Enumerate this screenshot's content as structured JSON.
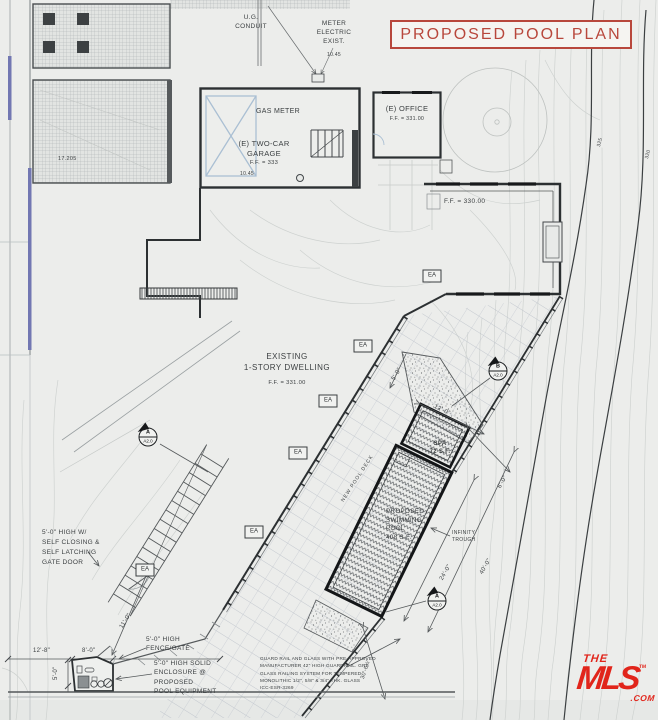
{
  "title": "PROPOSED POOL PLAN",
  "colors": {
    "title_red": "#b8473c",
    "mls_red": "#e1251b",
    "paper": "#ecedeb",
    "ink": "#3b3f41"
  },
  "site": {
    "ug_conduit": "U.G.\nCONDUIT",
    "meter_electric": "METER\nELECTRIC\nEXIST.",
    "gas_meter": "GAS METER",
    "garage_name": "(E) TWO-CAR\nGARAGE",
    "garage_ff": "F.F. = 333",
    "office_name": "(E) OFFICE",
    "office_ff": "F.F. = 331.00",
    "wing_ff": "F.F. = 330.00",
    "dwelling_name": "EXISTING\n1-STORY DWELLING",
    "dwelling_ff": "F.F. = 331.00",
    "spa": "SPA\n72 S.F.",
    "pool": "PROPOSED\nSWIMMING\nPOOL\n408 S.F.",
    "infinity": "INFINITY\nTROUGH",
    "deck_label": "NEW POOL DECK",
    "gate_door": "5'-0\" HIGH   W/\nSELF CLOSING &\nSELF LATCHING\nGATE DOOR",
    "fence_gate": "5'-0\" HIGH\nFENCE/GATE",
    "enclosure": "5'-0\" HIGH SOLID\nENCLOSURE @\nPROPOSED\nPOOL EQUIPMENT",
    "note": "GUARD RAIL AND GLASS WITH PRE-APPROVED\nMANUFACTURER 42\" HIGH GUARDRAIL.   GRS\nGLASS RAILING SYSTEM FOR TEMPERED\nMONOLITHIC 1/2\", 5/8\" & 3/4\" THK. GLASS\nICC-ESR-3269"
  },
  "markers": {
    "ea": "EA",
    "section_a": "A",
    "section_b": "B",
    "sheet": "A2.0"
  },
  "dims": {
    "d17205": "17.205",
    "d1045a": "10.45",
    "d1045b": "10.45",
    "d128": "12'-8\"",
    "d80": "8'-0\"",
    "d50": "5'-0\"",
    "d50b": "5'-0\"",
    "d110": "11'-0\"",
    "d3065": "30'-6½\"",
    "d240": "24'-0\"",
    "d400": "40'-0\"",
    "d60": "6'-0\"",
    "d120": "12'-0\"",
    "c325": "325",
    "c320": "320"
  },
  "watermark": {
    "the": "THE",
    "mls": "MLS",
    "com": ".COM",
    "tm": "TM"
  }
}
